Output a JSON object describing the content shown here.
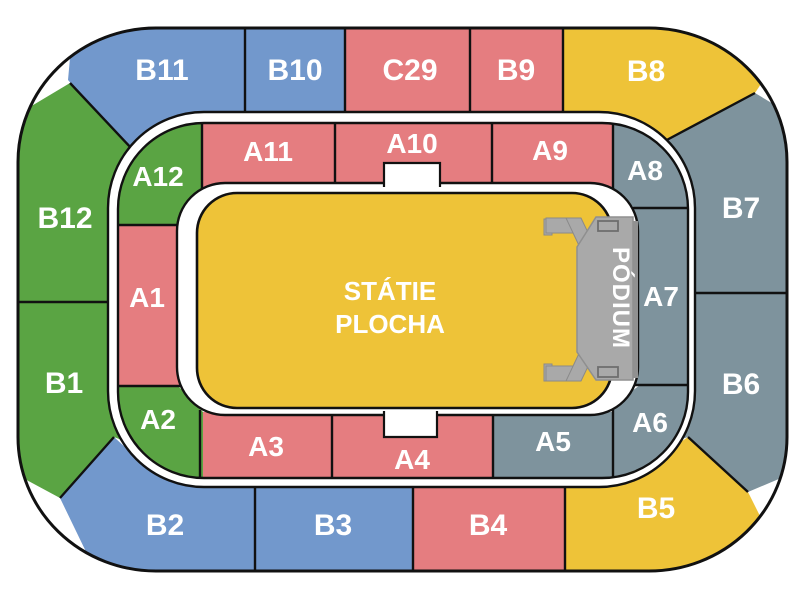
{
  "field": {
    "label_line1": "STÁTIE",
    "label_line2": "PLOCHA",
    "color": "#eec338"
  },
  "stage": {
    "label": "PÓDIUM",
    "color": "#a9a9a9",
    "shadow_color": "#919191",
    "detail_color": "#6e6e6e",
    "label_color": "#ffffff"
  },
  "colors": {
    "outline": "#111111",
    "walkway": "#ffffff",
    "label": "#ffffff"
  },
  "outer_ring": [
    {
      "label": "B11",
      "color": "#7298cc"
    },
    {
      "label": "B10",
      "color": "#7298cc"
    },
    {
      "label": "C29",
      "color": "#e57d80"
    },
    {
      "label": "B9",
      "color": "#e57d80"
    },
    {
      "label": "B8",
      "color": "#eec338"
    },
    {
      "label": "B7",
      "color": "#7e939d"
    },
    {
      "label": "B6",
      "color": "#7e939d"
    },
    {
      "label": "B5",
      "color": "#eec338"
    },
    {
      "label": "B4",
      "color": "#e57d80"
    },
    {
      "label": "B3",
      "color": "#7298cc"
    },
    {
      "label": "B2",
      "color": "#7298cc"
    },
    {
      "label": "B1",
      "color": "#5aa443"
    },
    {
      "label": "B12",
      "color": "#5aa443"
    }
  ],
  "inner_ring": [
    {
      "label": "A12",
      "color": "#5aa443"
    },
    {
      "label": "A11",
      "color": "#e57d80"
    },
    {
      "label": "A10",
      "color": "#e57d80"
    },
    {
      "label": "A9",
      "color": "#e57d80"
    },
    {
      "label": "A8",
      "color": "#7e939d"
    },
    {
      "label": "A7",
      "color": "#7e939d"
    },
    {
      "label": "A6",
      "color": "#7e939d"
    },
    {
      "label": "A5",
      "color": "#7e939d"
    },
    {
      "label": "A4",
      "color": "#e57d80"
    },
    {
      "label": "A3",
      "color": "#e57d80"
    },
    {
      "label": "A2",
      "color": "#5aa443"
    },
    {
      "label": "A1",
      "color": "#e57d80"
    }
  ]
}
